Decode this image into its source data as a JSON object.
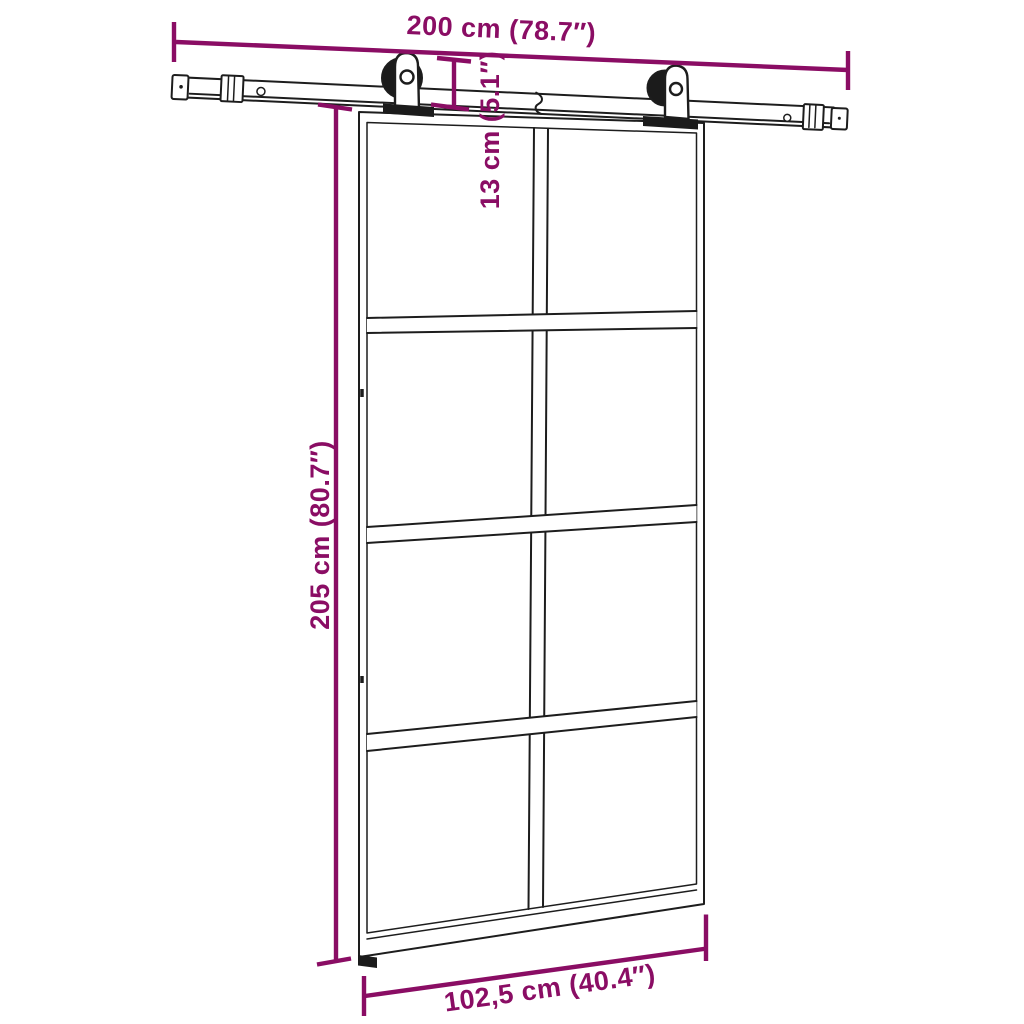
{
  "diagram": {
    "type": "product-dimension-diagram",
    "subject": "sliding glass door with barn-door rail hardware kit",
    "colors": {
      "accent": "#8A0D64",
      "line": "#1D1D1D",
      "hardware": "#1B1B1B",
      "background": "#FFFFFF"
    },
    "door": {
      "panel_rows": 4,
      "panel_columns": 2
    },
    "dimensions": {
      "rail_width": {
        "label": "200 cm (78.7″)",
        "metric": "200 cm",
        "imperial": "78.7″",
        "orientation": "horizontal"
      },
      "hardware_height": {
        "label": "13 cm (5.1″)",
        "metric": "13 cm",
        "imperial": "5.1″",
        "orientation": "vertical"
      },
      "door_height": {
        "label": "205 cm (80.7″)",
        "metric": "205 cm",
        "imperial": "80.7″",
        "orientation": "vertical"
      },
      "door_width": {
        "label": "102,5 cm (40.4″)",
        "metric": "102,5 cm",
        "imperial": "40.4″",
        "orientation": "horizontal"
      }
    }
  }
}
